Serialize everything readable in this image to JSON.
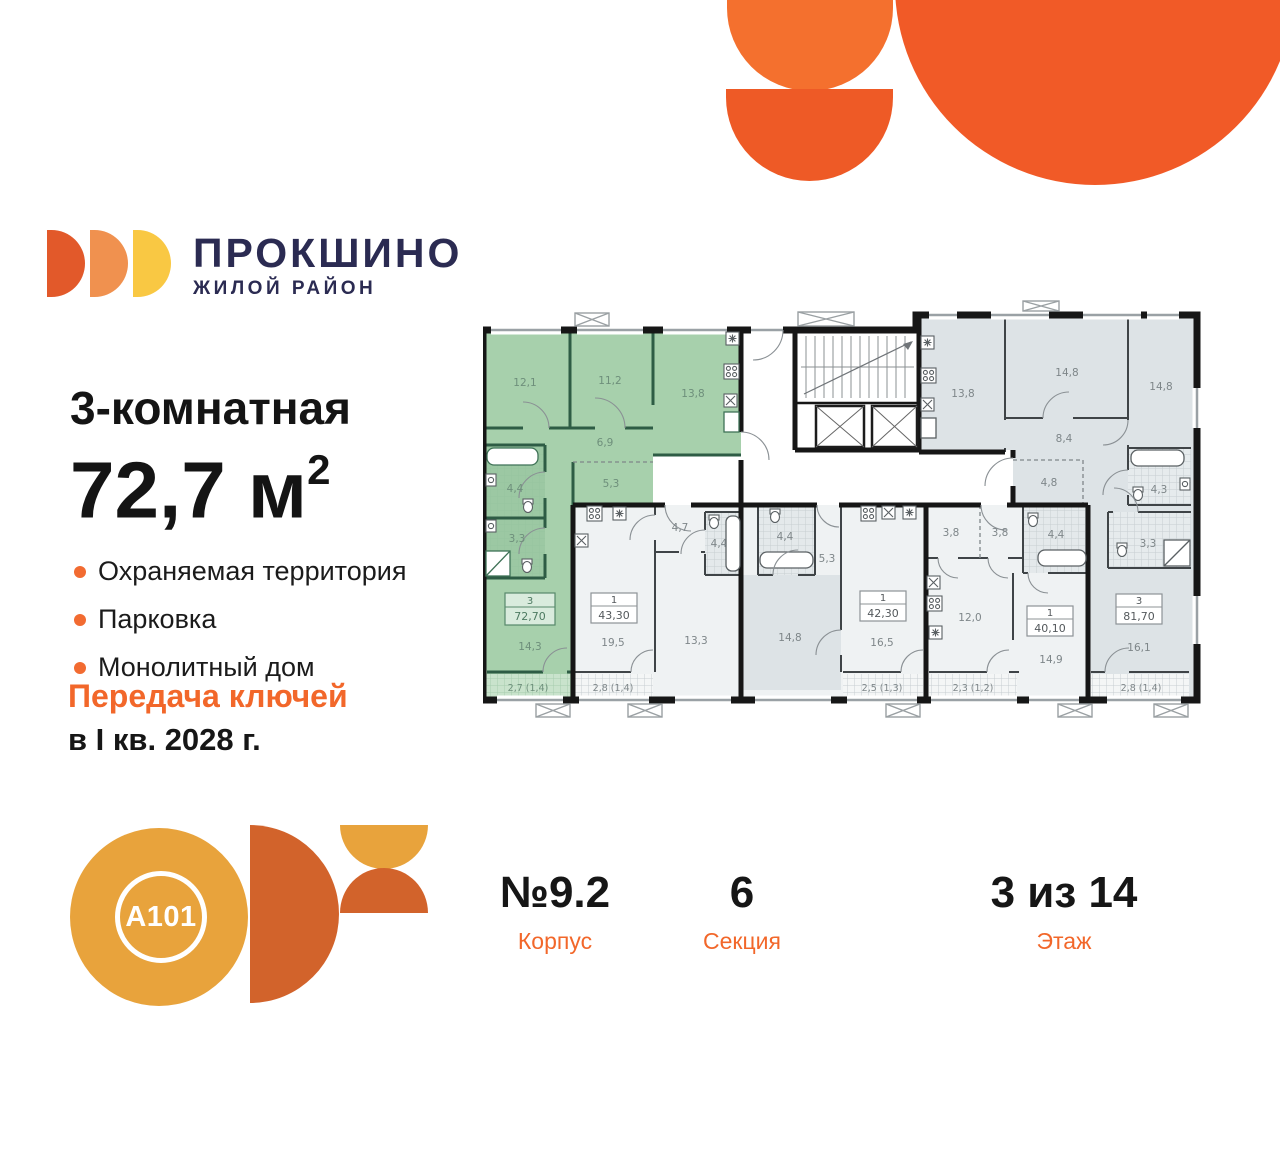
{
  "brand": {
    "name": "ПРОКШИНО",
    "tagline": "ЖИЛОЙ РАЙОН"
  },
  "listing": {
    "title": "3-комнатная",
    "area_value": "72,7 м",
    "area_sup": "2",
    "features": [
      "Охраняемая территория",
      "Парковка",
      "Монолитный дом"
    ],
    "keys_line1": "Передача ключей",
    "keys_line2": "в I кв. 2028 г."
  },
  "developer": {
    "logo_text": "A101"
  },
  "meta": {
    "building": {
      "value": "№9.2",
      "label": "Корпус"
    },
    "section": {
      "value": "6",
      "label": "Секция"
    },
    "floor": {
      "value": "3 из 14",
      "label": "Этаж"
    }
  },
  "plan": {
    "apartments": [
      {
        "number": "3",
        "area": "72,70",
        "highlighted": true,
        "rooms": [
          "12,1",
          "11,2",
          "13,8",
          "6,9",
          "5,3",
          "4,4",
          "3,3",
          "14,3"
        ],
        "balcony": "2,7 (1,4)"
      },
      {
        "number": "1",
        "area": "43,30",
        "rooms": [
          "19,5",
          "4,7",
          "4,4",
          "13,3"
        ],
        "balcony": "2,8 (1,4)"
      },
      {
        "number": "1",
        "area": "42,30",
        "rooms": [
          "16,5",
          "14,8",
          "5,3",
          "4,4"
        ],
        "balcony": "2,5 (1,3)"
      },
      {
        "number": "1",
        "area": "40,10",
        "rooms": [
          "12,0",
          "14,9",
          "3,8",
          "3,8",
          "4,4"
        ],
        "balcony": "2,3 (1,2)"
      },
      {
        "number": "3",
        "area": "81,70",
        "rooms": [
          "13,8",
          "14,8",
          "14,8",
          "8,4",
          "4,8",
          "4,3",
          "3,3",
          "16,1"
        ],
        "balcony": "2,8 (1,4)"
      }
    ]
  },
  "colors": {
    "accent_orange": "#F2672A",
    "navy": "#2B2B52",
    "highlight_green": "#A7D0AC",
    "room_gray": "#DDE3E6"
  }
}
